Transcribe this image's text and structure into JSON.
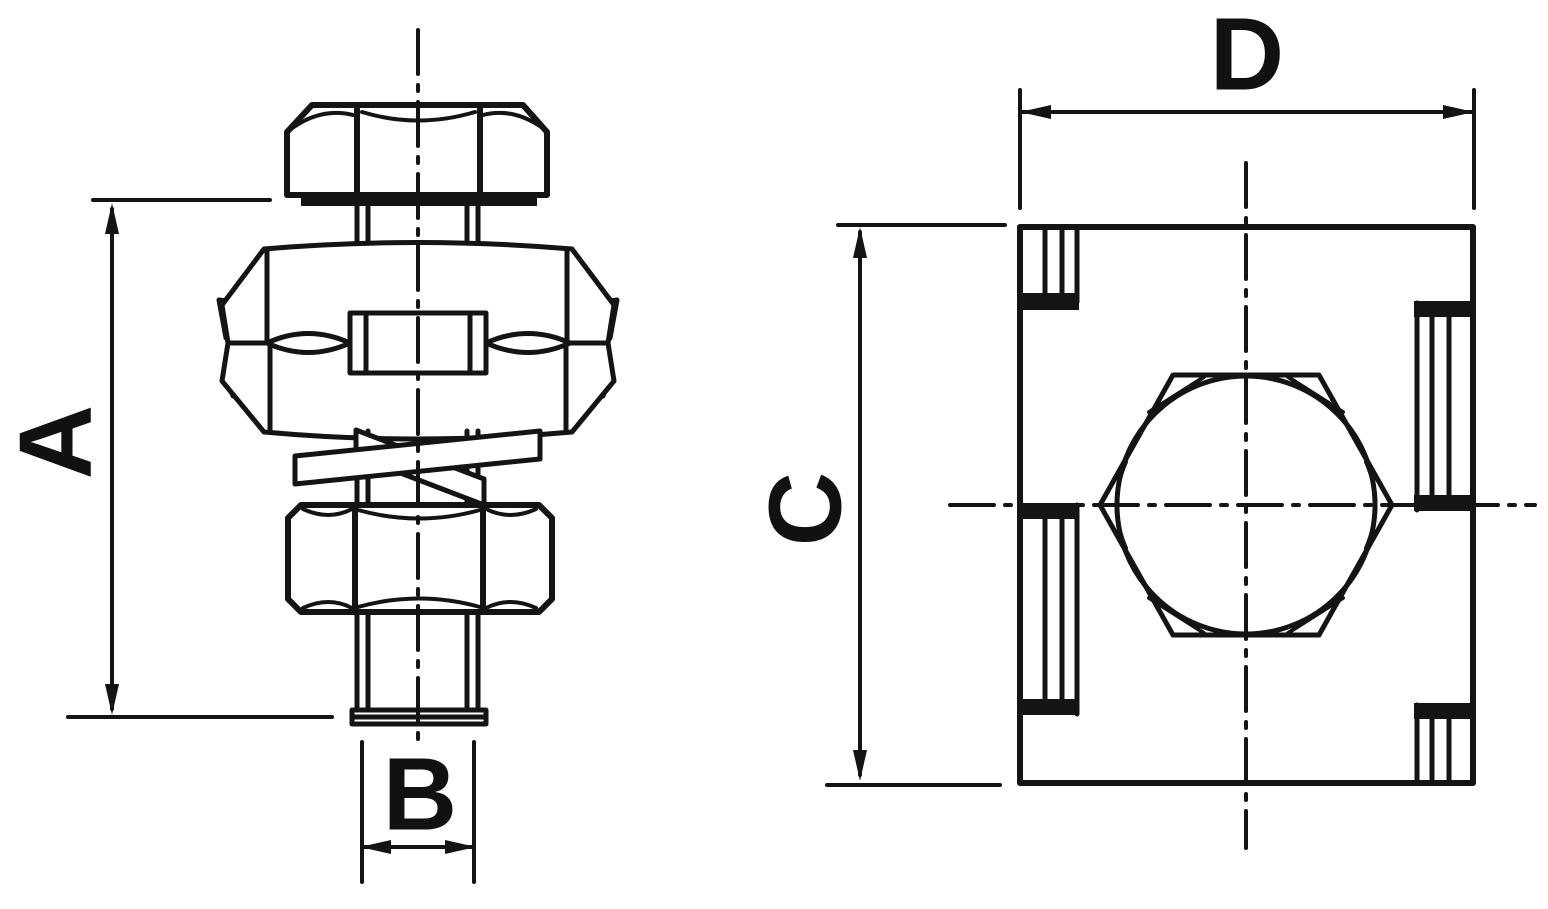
{
  "drawing": {
    "description": "Technical dimension drawing of a parallel groove clamp: front view with bolt, washer, clamp body, spring washer, nut and threaded stud; top view of square clamp body with hex nut",
    "background_color": "#ffffff",
    "line_color": "#141414",
    "dimension_labels": {
      "a": "A",
      "b": "B",
      "c": "C",
      "d": "D"
    }
  }
}
